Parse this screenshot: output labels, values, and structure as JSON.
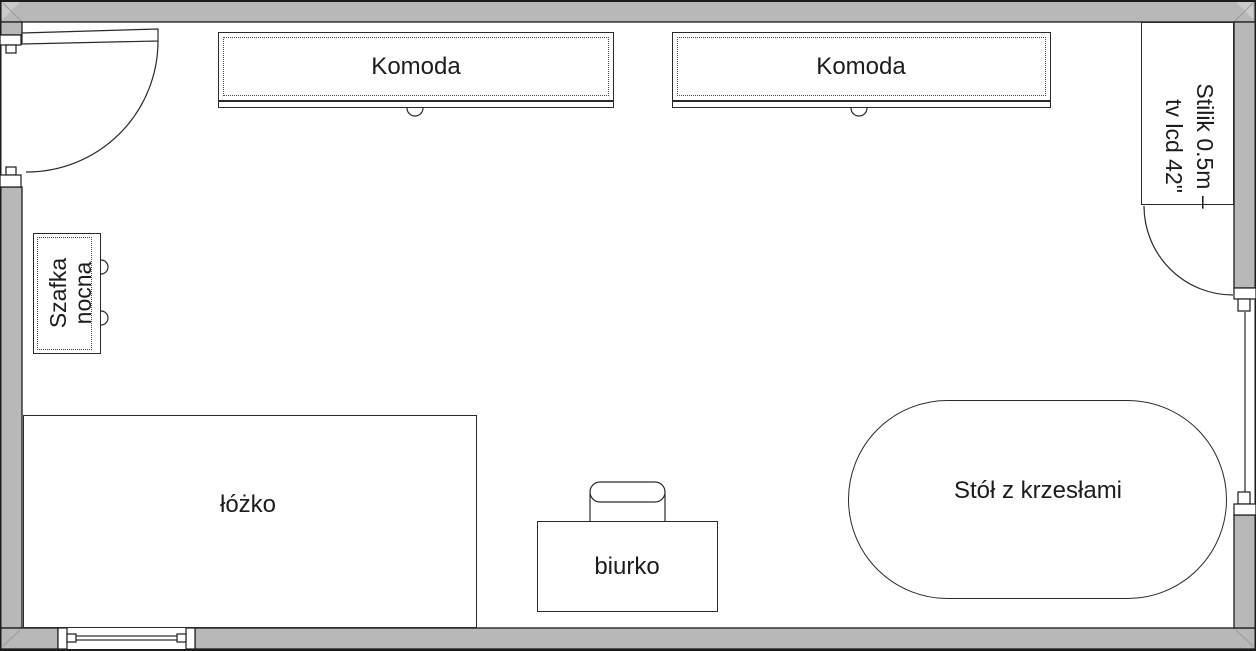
{
  "plan_title": "Room floor plan",
  "labels": {
    "komoda_1": "Komoda",
    "komoda_2": "Komoda",
    "szafka_line1": "Szafka",
    "szafka_line2": "nocna",
    "lozko": "łóżko",
    "biurko": "biurko",
    "stol": "Stół z krzesłami",
    "stolik_line1": "Stilik 0.5m –",
    "stolik_line2": "tv lcd 42\""
  },
  "colors": {
    "wall_fill": "#b8b8b8",
    "wall_edge": "#1c1c1c",
    "object_line": "#2a2a2a",
    "floor": "#ffffff",
    "text": "#1c1c1c"
  }
}
